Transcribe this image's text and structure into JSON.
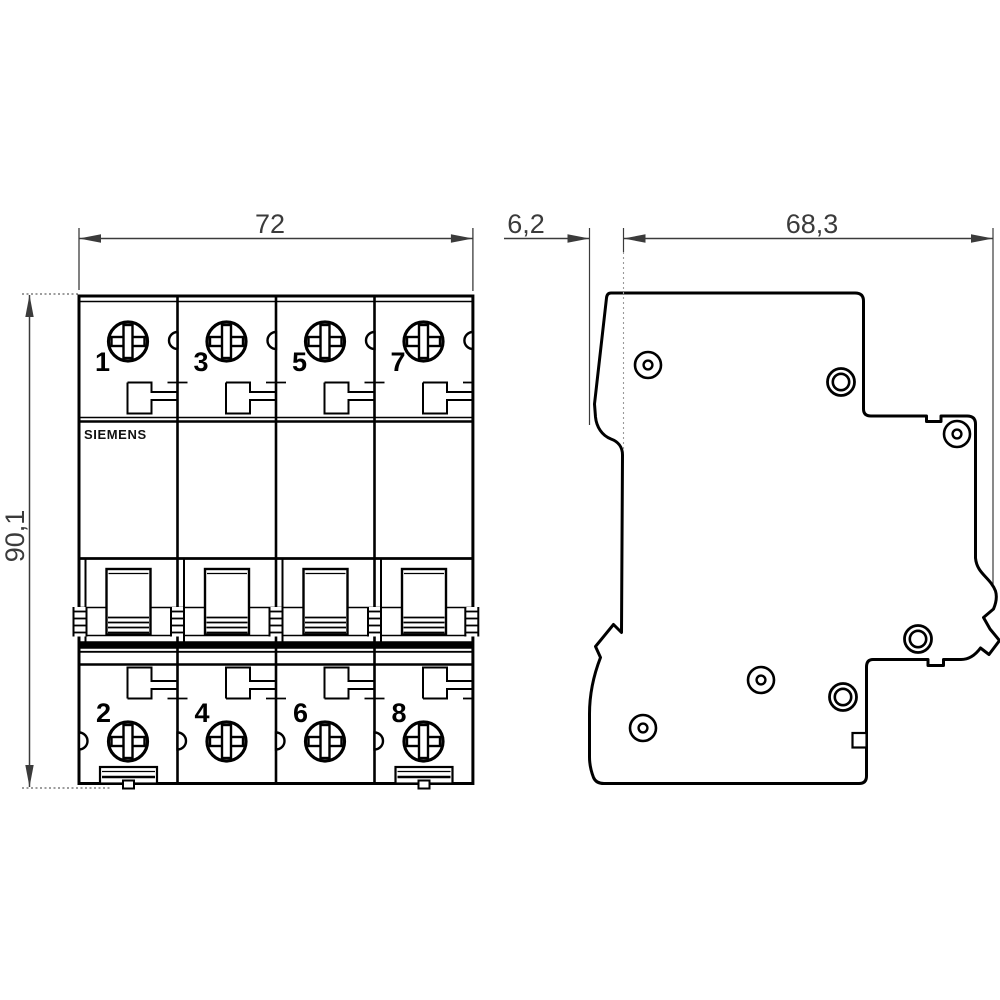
{
  "drawing": {
    "type": "technical-dimension-drawing",
    "views": {
      "front": {
        "brand": "SIEMENS",
        "pole_numbers_top": [
          "1",
          "3",
          "5",
          "7"
        ],
        "pole_numbers_bottom": [
          "2",
          "4",
          "6",
          "8"
        ]
      },
      "side": {}
    },
    "dimensions": {
      "front_width": "72",
      "front_height": "90,1",
      "side_front_depth": "6,2",
      "side_body_depth": "68,3"
    },
    "colors": {
      "line": "#000000",
      "dimension": "#3b3b3b",
      "background": "#ffffff"
    }
  }
}
